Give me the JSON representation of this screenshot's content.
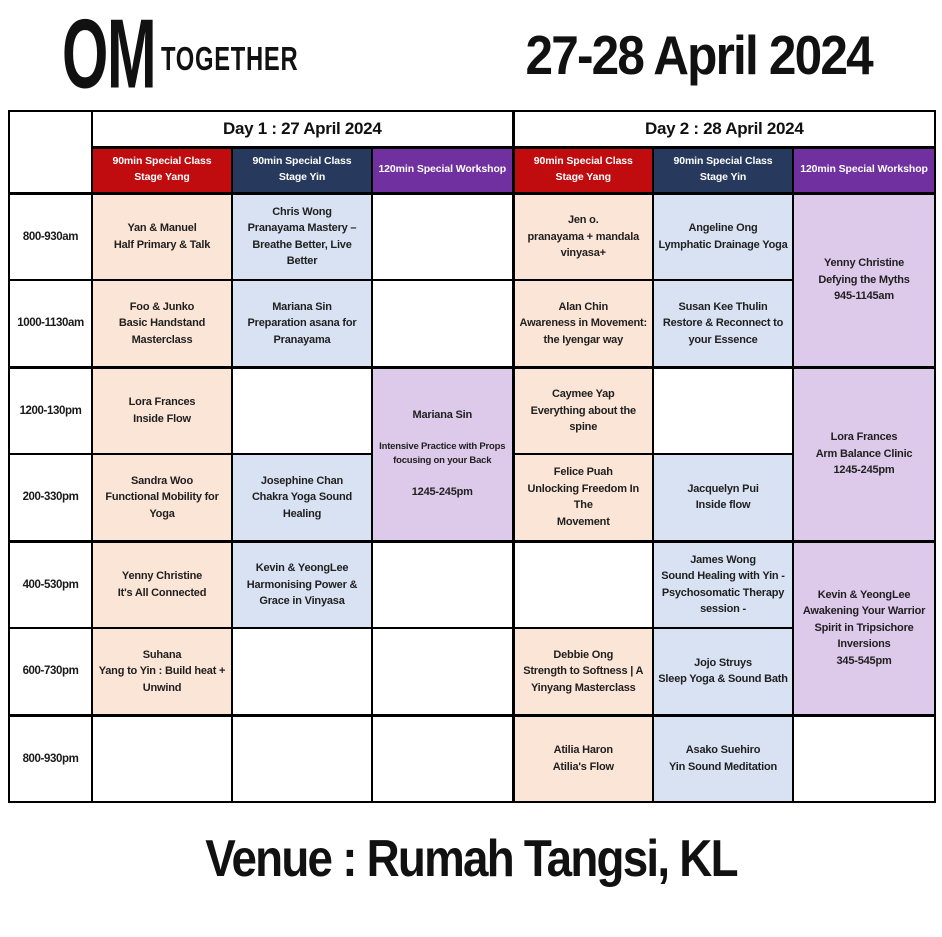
{
  "header": {
    "logo_om": "OM",
    "logo_together": "TOGETHER",
    "title": "27-28 April 2024"
  },
  "footer": {
    "venue": "Venue : Rumah Tangsi, KL"
  },
  "colors": {
    "yang_header": "#c00b0f",
    "yin_header": "#273a5e",
    "workshop_header": "#7030a0",
    "yang_cell": "#fbe5d6",
    "yin_cell": "#d9e2f3",
    "workshop_cell": "#ddc9ea",
    "border": "#000000"
  },
  "schedule": {
    "days": [
      {
        "label": "Day 1 : 27 April 2024"
      },
      {
        "label": "Day 2 : 28 April 2024"
      }
    ],
    "class_headers": [
      "90min Special Class\nStage Yang",
      "90min Special Class\nStage Yin",
      "120min Special Workshop"
    ],
    "time_slots": [
      "800-930am",
      "1000-1130am",
      "1200-130pm",
      "200-330pm",
      "400-530pm",
      "600-730pm",
      "800-930pm"
    ]
  },
  "grid": {
    "day1_yang": [
      "Yan & Manuel\nHalf Primary & Talk",
      "Foo & Junko\nBasic Handstand\nMasterclass",
      "Lora Frances\nInside Flow",
      "Sandra Woo\nFunctional Mobility for Yoga",
      "Yenny Christine\nIt's All Connected",
      "Suhana\nYang to Yin : Build heat +\nUnwind",
      ""
    ],
    "day1_yin": [
      "Chris Wong\nPranayama Mastery –\nBreathe Better, Live Better",
      "Mariana Sin\nPreparation asana for\nPranayama",
      "",
      "Josephine Chan\nChakra Yoga Sound Healing",
      "Kevin & YeongLee\nHarmonising Power &\nGrace in Vinyasa",
      "",
      ""
    ],
    "day1_workshop_rows34": {
      "teacher": "Mariana Sin",
      "detail": "Intensive Practice with Props\nfocusing on your Back",
      "time": "1245-245pm"
    },
    "day2_yang": [
      "Jen o.\npranayama + mandala\nvinyasa+",
      "Alan Chin\nAwareness in Movement:\nthe Iyengar way",
      "Caymee Yap\nEverything about the spine",
      "Felice Puah\nUnlocking Freedom In The\nMovement",
      "",
      "Debbie Ong\nStrength to Softness | A\nYinyang Masterclass",
      "Atilia Haron\nAtilia's Flow"
    ],
    "day2_yin": [
      "Angeline Ong\nLymphatic Drainage Yoga",
      "Susan Kee Thulin\nRestore & Reconnect to\nyour Essence",
      "",
      "Jacquelyn Pui\nInside flow",
      "James Wong\nSound Healing with Yin -\nPsychosomatic Therapy\nsession -",
      "Jojo Struys\nSleep Yoga & Sound Bath",
      "Asako Suehiro\nYin Sound Meditation"
    ],
    "day2_workshop_rows12": "Yenny Christine\nDefying the Myths\n945-1145am",
    "day2_workshop_rows34": "Lora Frances\nArm Balance Clinic\n1245-245pm",
    "day2_workshop_rows56": "Kevin & YeongLee\nAwakening Your Warrior\nSpirit in Tripsichore\nInversions\n345-545pm"
  }
}
